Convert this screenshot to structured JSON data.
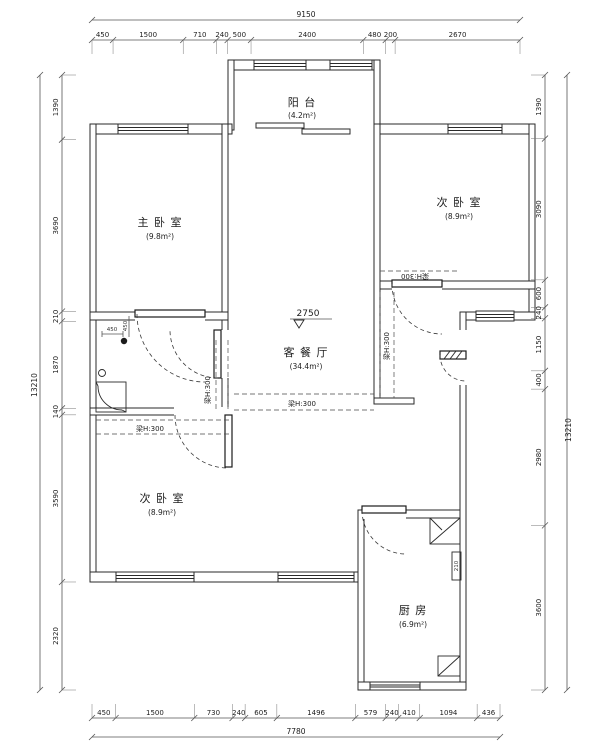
{
  "colors": {
    "line": "#2a2a2a",
    "dim": "#555555",
    "bg": "#ffffff"
  },
  "rooms": {
    "balcony": {
      "name": "阳 台",
      "area": "(4.2m²)"
    },
    "master": {
      "name": "主 卧 室",
      "area": "(9.8m²)"
    },
    "bedroom2": {
      "name": "次 卧 室",
      "area": "(8.9m²)"
    },
    "living": {
      "name": "客 餐 厅",
      "area": "(34.4m²)"
    },
    "bedroom3": {
      "name": "次 卧 室",
      "area": "(8.9m²)"
    },
    "kitchen": {
      "name": "厨 房",
      "area": "(6.9m²)"
    }
  },
  "annotations": {
    "level": "2750",
    "beam": "梁H:300",
    "dim450a": "450",
    "dim450b": "450",
    "dim210": "210"
  },
  "dimensions": {
    "top": {
      "total": "9150",
      "segments": [
        450,
        1500,
        710,
        240,
        500,
        2400,
        480,
        200,
        2670
      ]
    },
    "bottom": {
      "total": "7780",
      "segments": [
        450,
        1500,
        730,
        240,
        605,
        1496,
        579,
        240,
        410,
        1094,
        436
      ]
    },
    "left": {
      "total": "13210",
      "segments": [
        1390,
        3690,
        210,
        1870,
        140,
        3590,
        2320
      ]
    },
    "right": {
      "total": "13210",
      "segments": [
        1390,
        3090,
        600,
        240,
        1150,
        400,
        2980,
        3600
      ]
    }
  }
}
